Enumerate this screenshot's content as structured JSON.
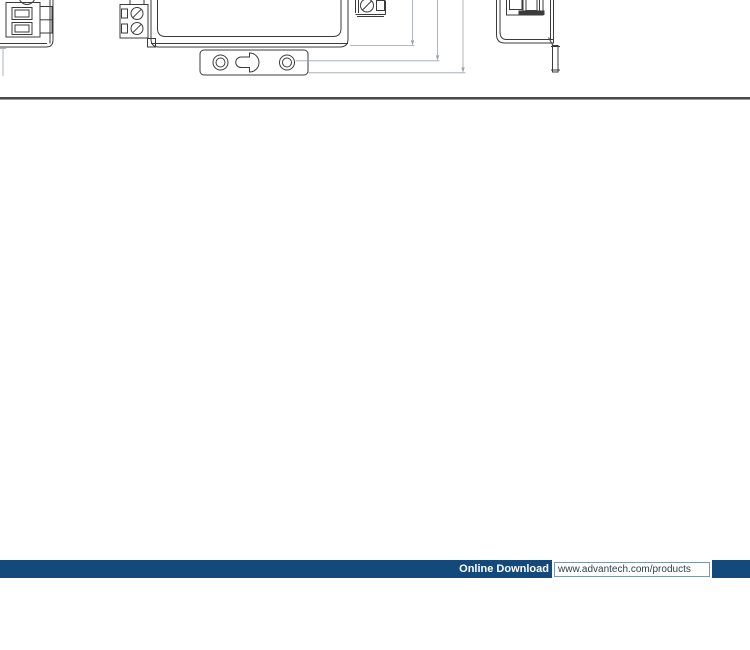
{
  "page": {
    "background": "#ffffff"
  },
  "drawing": {
    "description": "product dimension drawing, three views cut off at top of screenshot",
    "views": [
      "side-view-left",
      "front-view-with-mounting-plate",
      "side-view-right"
    ],
    "line_color": "#3b3b3b",
    "dimension_line_color": "#9aa3ab"
  },
  "divider": {
    "color": "#4a4a4a"
  },
  "footer": {
    "label": "Online Download",
    "url": "www.advantech.com/products",
    "bar_color": "#14497C",
    "label_color": "#ffffff",
    "url_text_color": "#2e3d4c",
    "box_background": "#ffffff"
  }
}
